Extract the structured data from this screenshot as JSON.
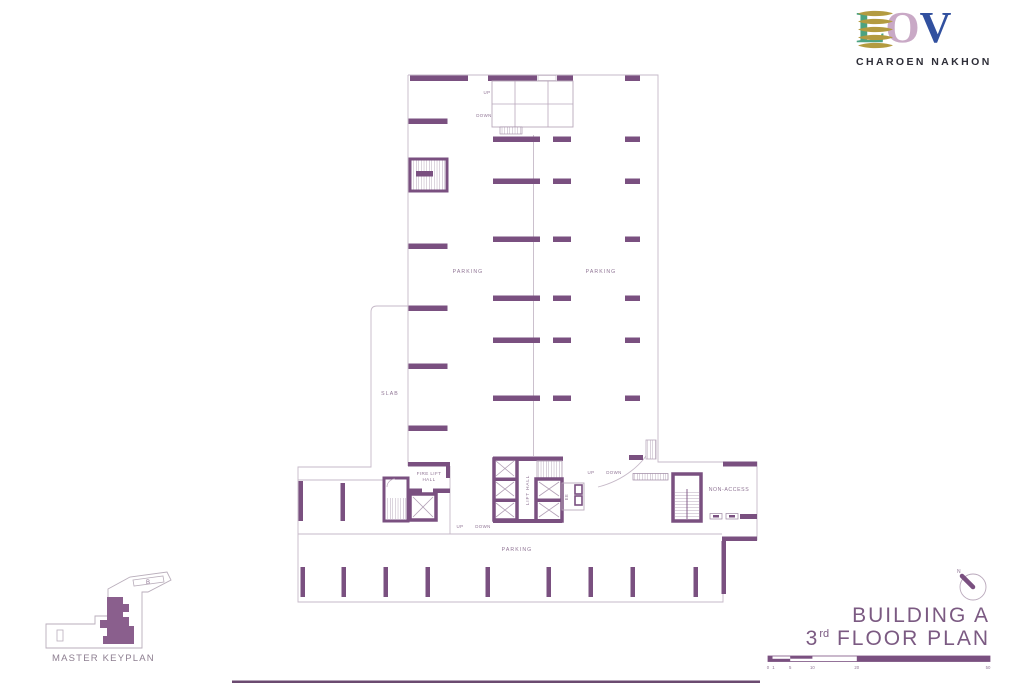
{
  "brand": {
    "logo_l": "L",
    "logo_o": "O",
    "logo_v": "V",
    "subtitle": "CHAROEN NAKHON",
    "colors": {
      "l": "#4ca381",
      "o": "#c9a9c6",
      "v": "#31509f",
      "leaf": "#b39b40",
      "subtitle": "#2e2e38"
    }
  },
  "plan": {
    "colors": {
      "wall": "#7a5080",
      "line": "#c6b9c8",
      "label": "#8f7494"
    },
    "labels": {
      "parking_left": "PARKING",
      "parking_right": "PARKING",
      "parking_bottom": "PARKING",
      "slab": "SLAB",
      "fire_lift_line1": "FIRE LIFT",
      "fire_lift_line2": "HALL",
      "lift_hall": "LIFT HALL",
      "ee": "EE",
      "non_access": "NON-ACCESS",
      "ramp_up": "UP",
      "ramp_down": "DOWN",
      "core_up": "UP",
      "core_down": "DOWN",
      "ramp2_up": "UP",
      "ramp2_down": "DOWN"
    }
  },
  "keyplan": {
    "title": "MASTER KEYPLAN",
    "building_b": "B"
  },
  "titleblock": {
    "building": "BUILDING A",
    "floor_number": "3",
    "floor_suffix": "rd",
    "floor_text": " FLOOR PLAN",
    "compass_n": "N",
    "scale_ticks": [
      "0",
      "1",
      "5",
      "10",
      "20",
      "50"
    ]
  }
}
